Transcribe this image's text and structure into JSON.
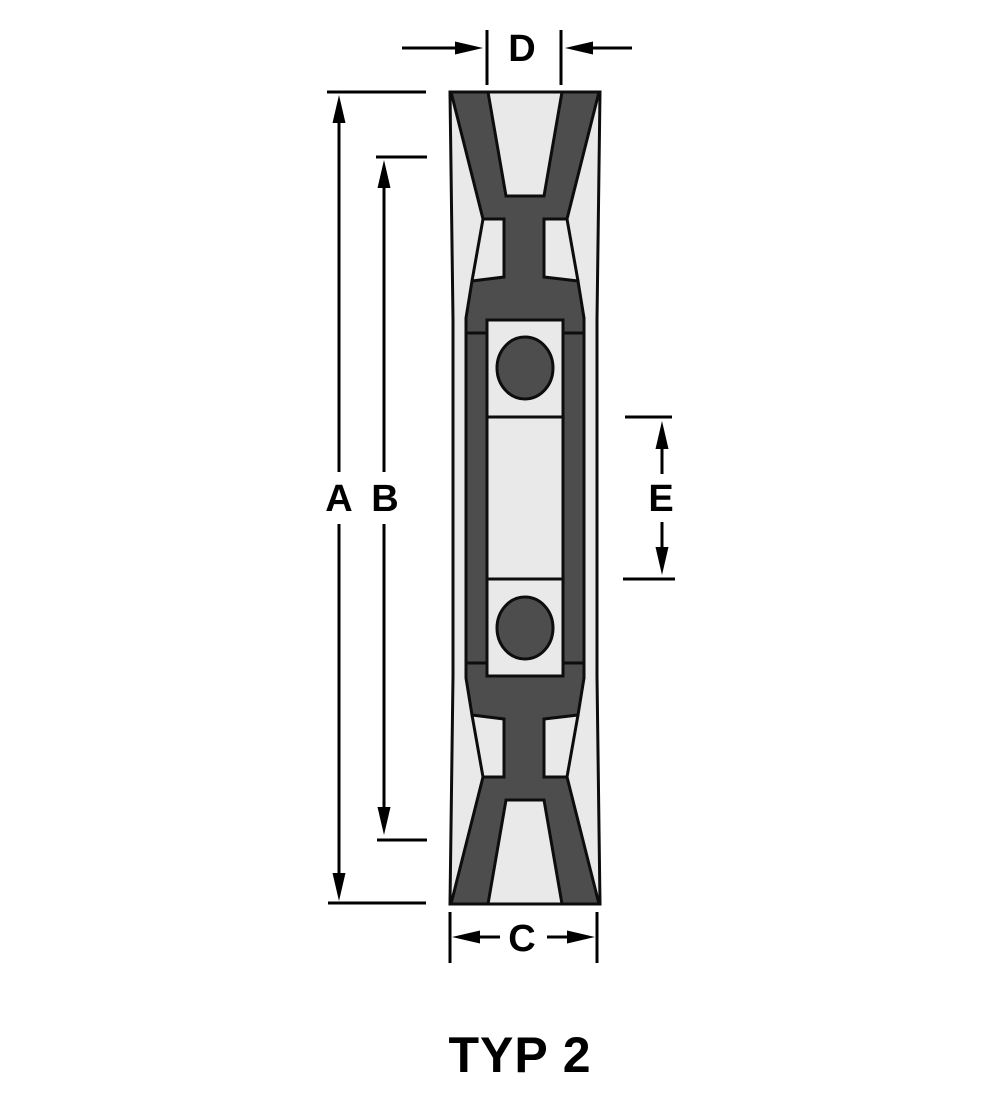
{
  "figure": {
    "title": "TYP 2",
    "kind": "v-belt pulley cross-section drawing"
  },
  "dimension_labels": {
    "a": "A",
    "b": "B",
    "c": "C",
    "d": "D",
    "e": "E"
  },
  "colors": {
    "background": "#ffffff",
    "surface": "#e9e9e9",
    "section": "#4d4d4d",
    "line": "#000000"
  }
}
